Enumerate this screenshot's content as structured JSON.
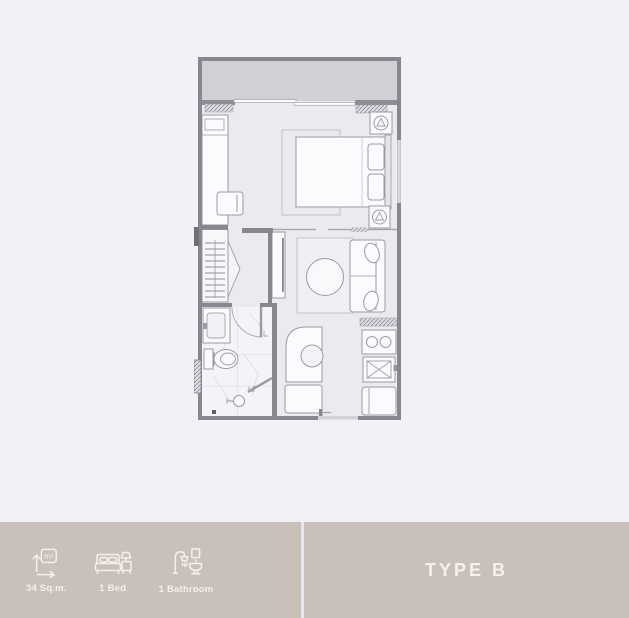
{
  "footer": {
    "stats": [
      {
        "icon": "area-icon",
        "label": "34 Sq.m."
      },
      {
        "icon": "bed-icon",
        "label": "1 Bed"
      },
      {
        "icon": "bathroom-icon",
        "label": "1 Bathroom"
      }
    ],
    "type_label": "TYPE B"
  },
  "colors": {
    "page_background": "#f2f1f8",
    "footer_bar": "#c9c0ba",
    "footer_text": "#f3f0ed",
    "footer_divider": "#e9e7ee",
    "wall": "#87878f",
    "balcony_fill": "#d0d0d5",
    "floor_fill": "#ebeaef",
    "bathroom_floor": "#f4f3f7",
    "furniture_fill": "#fbfbfd",
    "furniture_stroke": "#9a9aa4"
  }
}
